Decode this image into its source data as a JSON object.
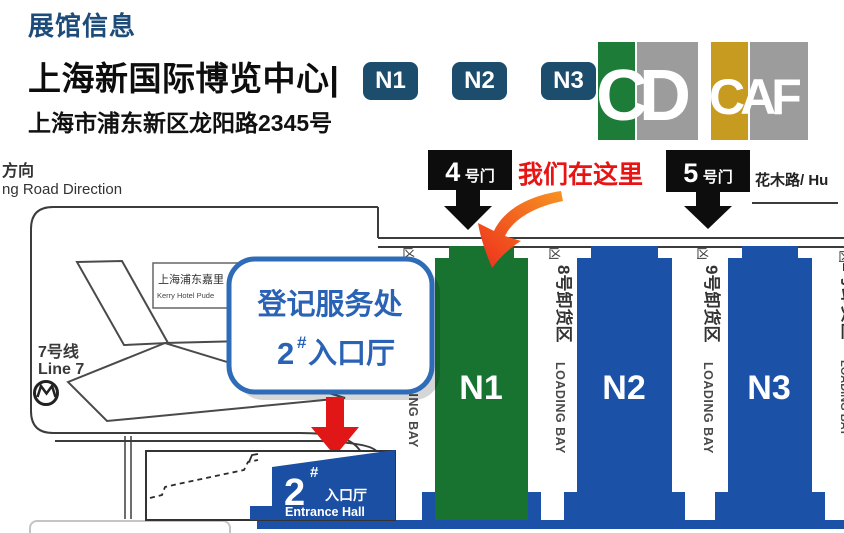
{
  "header": {
    "section_title": "展馆信息",
    "venue_name": "上海新国际博览中心|",
    "badges": [
      "N1",
      "N2",
      "N3"
    ],
    "address": "上海市浦东新区龙阳路2345号",
    "logos": {
      "cd_letters": "CD",
      "caf_letters": "CAF"
    }
  },
  "map": {
    "direction_zh": "方向",
    "direction_en": "ng Road Direction",
    "metro_zh": "7号线",
    "metro_en": "Line 7",
    "kerry_zh": "上海浦东嘉里",
    "kerry_en": "Kerry Hotel Pude",
    "gate4_num": "4",
    "gate4_suffix": "号门",
    "gate5_num": "5",
    "gate5_suffix": "号门",
    "here_text": "我们在这里",
    "huamu_road": "花木路/ Hu",
    "callout": {
      "line1": "登记服务处",
      "num": "2",
      "sup": "#",
      "rest": "入口厅"
    },
    "halls": [
      {
        "label": "N1"
      },
      {
        "label": "N2"
      },
      {
        "label": "N3"
      }
    ],
    "dock_glyph": "凶",
    "bays": [
      {
        "zh": "",
        "en": "LOADING BAY"
      },
      {
        "zh": "8号卸货区",
        "en": "LOADING BAY"
      },
      {
        "zh": "9号卸货区",
        "en": "LOADING BAY"
      },
      {
        "zh": "1号卸货区",
        "en": "LOADING BAY"
      }
    ],
    "entrance": {
      "num": "2",
      "sup": "#",
      "zh": "入口厅",
      "en": "Entrance Hall"
    }
  },
  "colors": {
    "title_navy": "#1D4B7A",
    "badge_navy": "#1D4D6D",
    "hall_green": "#187331",
    "hall_blue": "#1B52A8",
    "entrance_blue": "#1B4FA3",
    "callout_blue": "#2E6CB8",
    "callout_text_blue": "#2A63B5",
    "here_red": "#E81414",
    "arrow_red": "#E11717",
    "logo_green": "#1E7C39",
    "logo_gold": "#C79A20",
    "logo_gray": "#9C9C9C"
  }
}
